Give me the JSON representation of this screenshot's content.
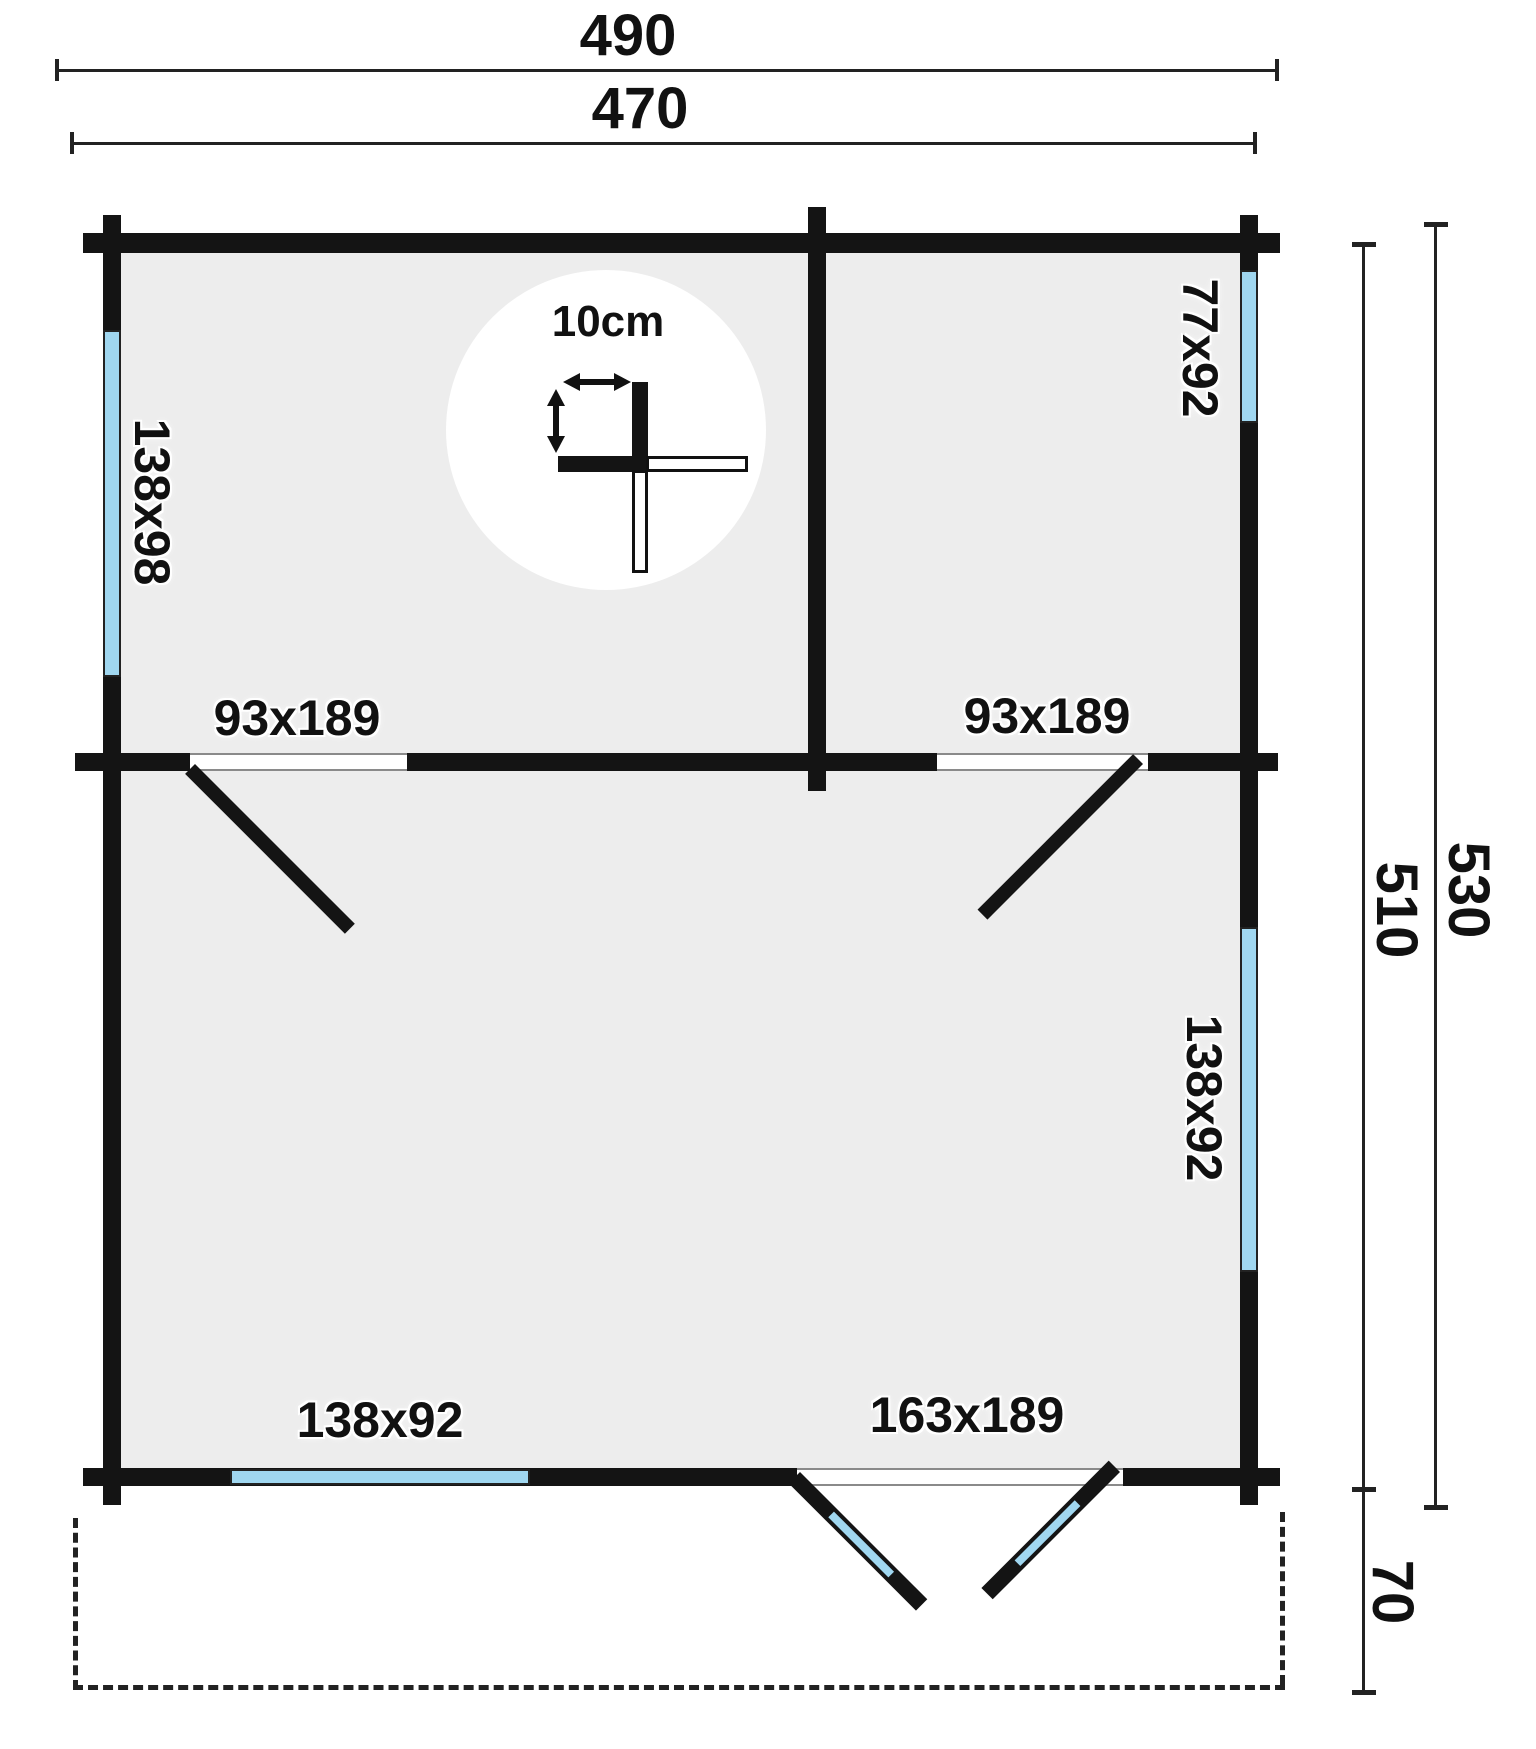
{
  "diagram": {
    "kind": "log-cabin floor plan",
    "dims": {
      "width_outer": "490",
      "width_inner": "470",
      "depth_outer": "530",
      "depth_inner": "510",
      "terrace_depth": "70"
    },
    "wall_thickness": {
      "label": "10cm"
    },
    "windows": {
      "left": "138x98",
      "top_right": "77x92",
      "right": "138x92",
      "bottom": "138x92"
    },
    "doors": {
      "interior_left": "93x189",
      "interior_right": "93x189",
      "exterior_double": "163x189"
    },
    "colors": {
      "wall": "#141414",
      "floor": "#ededed",
      "glass": "#a0d7f0",
      "dimension_line": "#222222",
      "background": "#ffffff"
    }
  }
}
